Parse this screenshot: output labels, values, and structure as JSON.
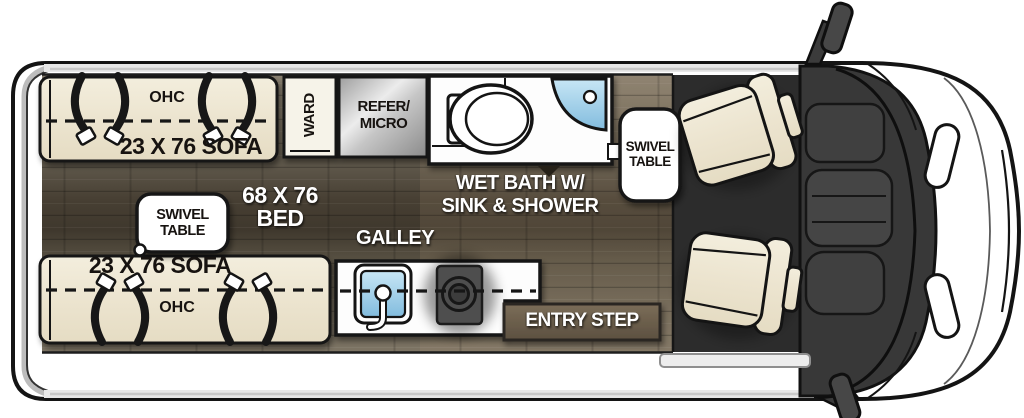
{
  "plan_title": "Class B camper van floorplan (top view)",
  "labels": {
    "sofa_top": "23 X 76 SOFA",
    "sofa_top_ohc": "OHC",
    "sofa_bottom": "23 X 76 SOFA",
    "sofa_bottom_ohc": "OHC",
    "ward": "WARD",
    "refer_line1": "REFER/",
    "refer_line2": "MICRO",
    "wet_bath_line1": "WET BATH W/",
    "wet_bath_line2": "SINK & SHOWER",
    "swivel_right_line1": "SWIVEL",
    "swivel_right_line2": "TABLE",
    "swivel_left_line1": "SWIVEL",
    "swivel_left_line2": "TABLE",
    "bed_line1": "68 X 76",
    "bed_line2": "BED",
    "galley": "GALLEY",
    "entry_step": "ENTRY STEP"
  },
  "colors": {
    "outline": "#141414",
    "van_body": "#ffffff",
    "sofa_cream": "#ece4cf",
    "seat_cream": "#efe7cb",
    "floor_wood_light": "#7d7464",
    "floor_wood_dark": "#3f382d",
    "cab_dark": "#2c2c2c",
    "dash_gray": "#3a3a3a",
    "sink_blue": "#9ed2ec",
    "step_brown": "#6b5e4a",
    "label_white": "#ffffff",
    "label_black": "#171310"
  }
}
